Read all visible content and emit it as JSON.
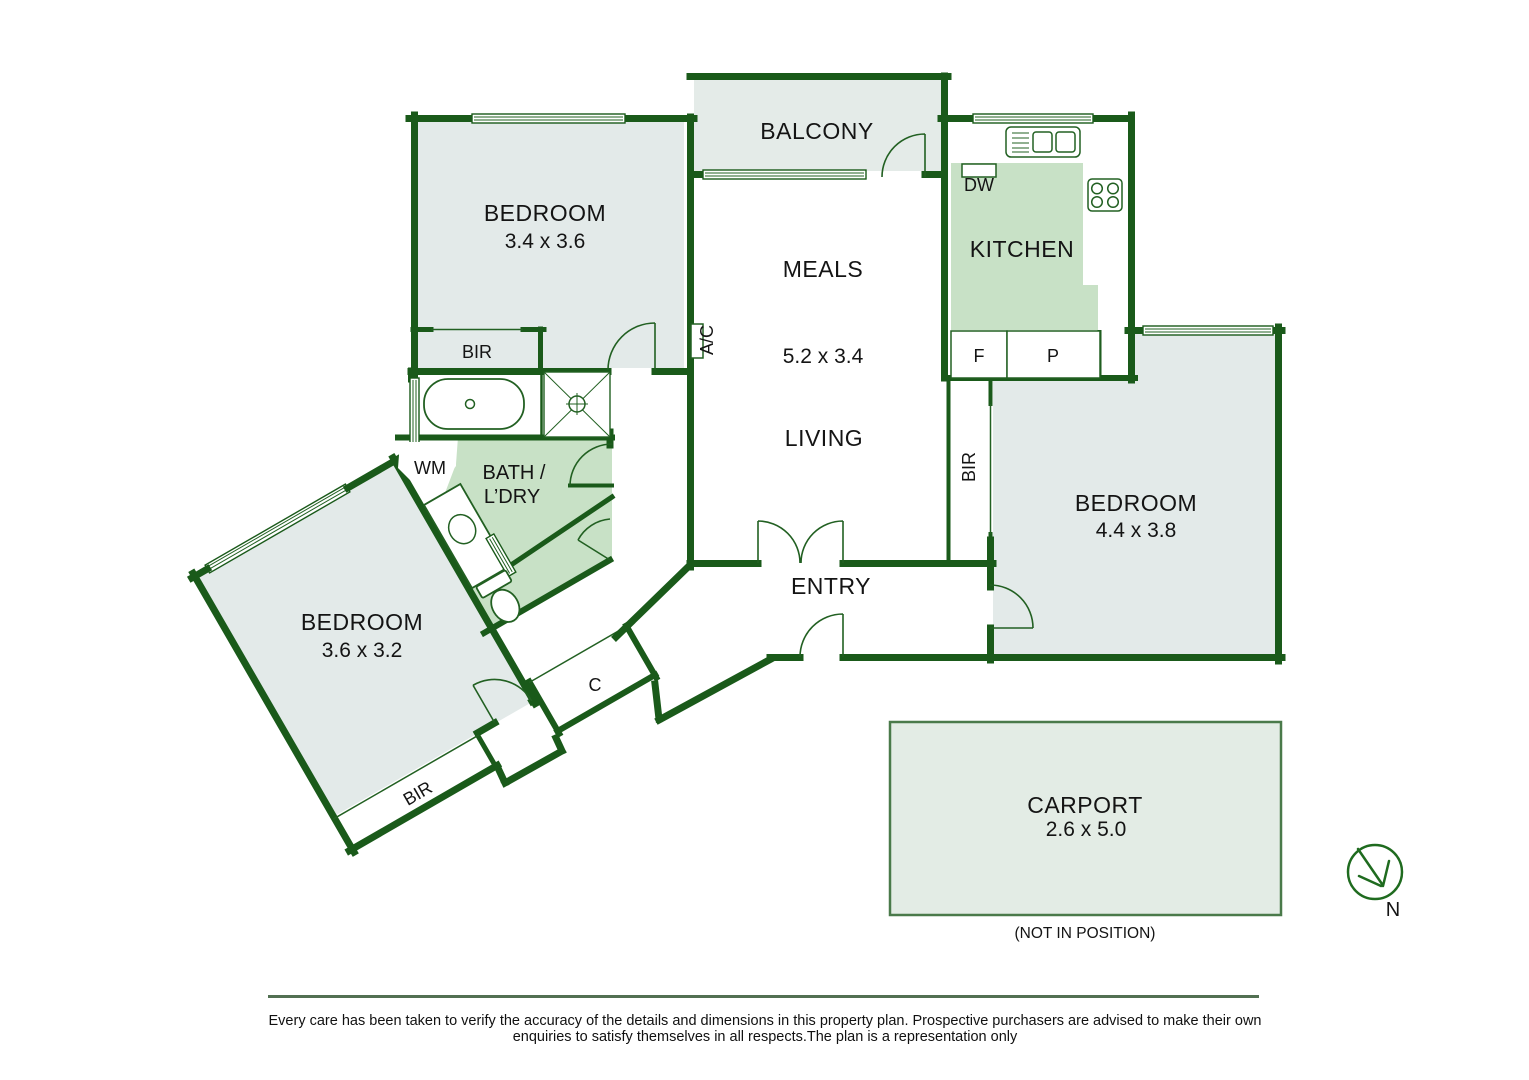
{
  "rooms": {
    "balcony": {
      "label": "BALCONY"
    },
    "bedroom1": {
      "label": "BEDROOM",
      "dims": "3.4 x 3.6"
    },
    "meals": {
      "label": "MEALS",
      "dims": "5.2 x 3.4"
    },
    "living": {
      "label": "LIVING"
    },
    "kitchen": {
      "label": "KITCHEN"
    },
    "bedroom2": {
      "label": "BEDROOM",
      "dims": "4.4 x 3.8"
    },
    "bath": {
      "line1": "BATH /",
      "line2": "L’DRY"
    },
    "bedroom3": {
      "label": "BEDROOM",
      "dims": "3.6 x 3.2"
    },
    "entry": {
      "label": "ENTRY"
    },
    "carport": {
      "label": "CARPORT",
      "dims": "2.6 x 5.0",
      "note": "(NOT IN POSITION)"
    }
  },
  "features": {
    "bir": "BIR",
    "dw": "DW",
    "wm": "WM",
    "fridge": "F",
    "pantry": "P",
    "closet": "C",
    "ac": "A/C"
  },
  "compass": {
    "label": "N"
  },
  "disclaimer": {
    "line1": "Every care has been taken to verify the accuracy of the details and dimensions in this property plan. Prospective purchasers are advised to make their own",
    "line2": "enquiries to satisfy themselves in all respects.The plan is a representation only"
  },
  "colors": {
    "wall": "#1a5a1a",
    "room_fill": "#e3eae9",
    "outdoor_fill": "#e4ebe8",
    "wet_area_fill": "#c8e1c6",
    "footer_rule": "#527052",
    "text": "#141414"
  }
}
